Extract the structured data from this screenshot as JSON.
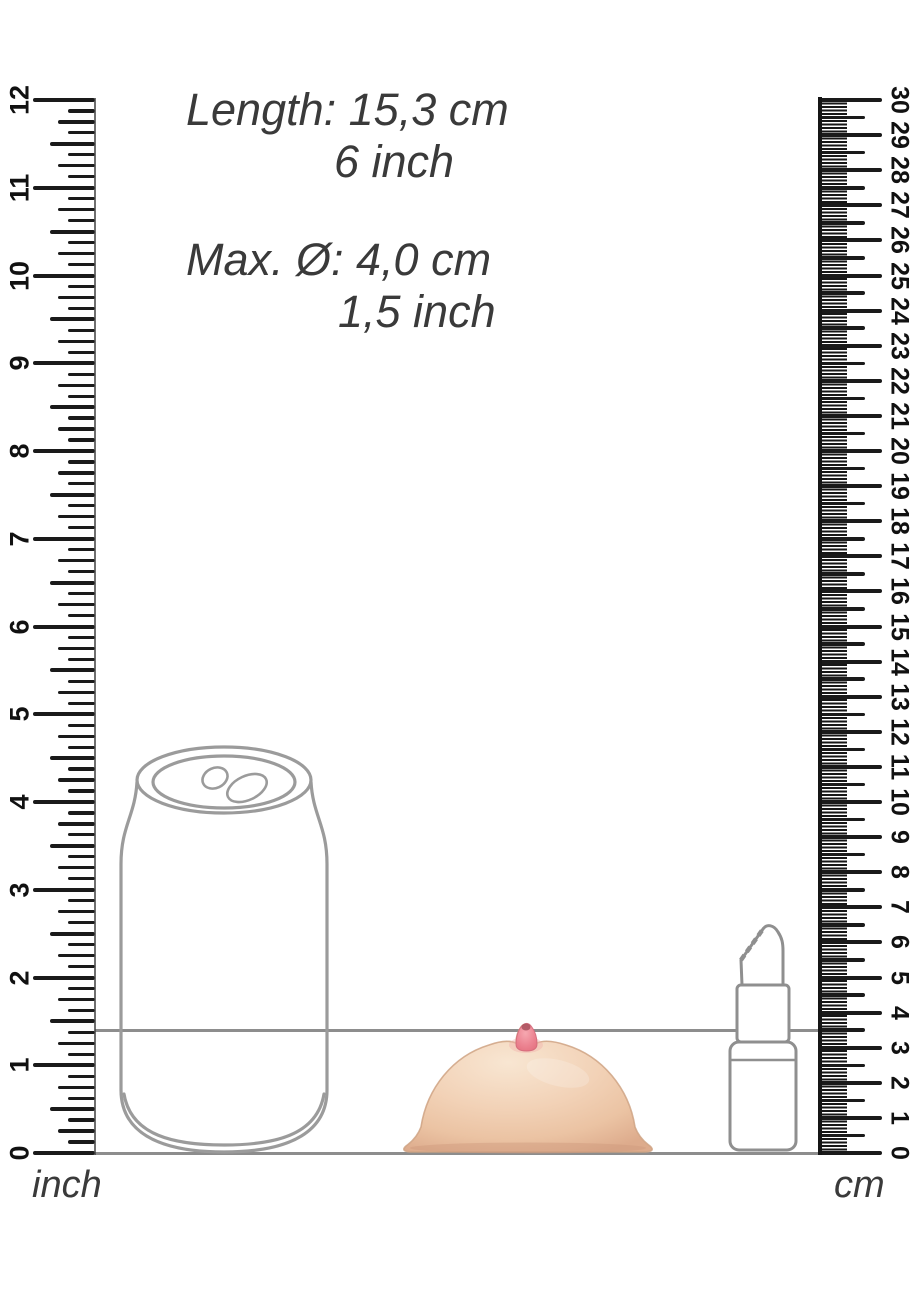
{
  "annotations": {
    "length": {
      "line1": "Length: 15,3 cm",
      "line2": "6 inch"
    },
    "diameter": {
      "line1": "Max. Ø: 4,0 cm",
      "line2": "1,5 inch"
    }
  },
  "rulers": {
    "inch": {
      "label": "inch",
      "numbers": [
        0,
        1,
        2,
        3,
        4,
        5,
        6,
        7,
        8,
        9,
        10,
        11,
        12
      ]
    },
    "cm": {
      "label": "cm",
      "numbers": [
        0,
        1,
        2,
        3,
        4,
        5,
        6,
        7,
        8,
        9,
        10,
        11,
        12,
        13,
        14,
        15,
        16,
        17,
        18,
        19,
        20,
        21,
        22,
        23,
        24,
        25,
        26,
        27,
        28,
        29,
        30
      ]
    }
  },
  "reference_lines": {
    "product_height_cm": 3.5,
    "baseline_cm": 0
  },
  "objects": {
    "soda_can": "soda-can",
    "breast_product": "breast-shaped-product",
    "lipstick": "lipstick"
  },
  "colors": {
    "outline": "#9b9b9b",
    "reference_line": "#8d8d8d",
    "tick": "#1a1a1a",
    "text": "#3a3a3a",
    "skin": "#f2d2b7",
    "skin_shadow": "#ddab8c",
    "nipple": "#ec8492",
    "nipple_tip": "#a8515d"
  }
}
